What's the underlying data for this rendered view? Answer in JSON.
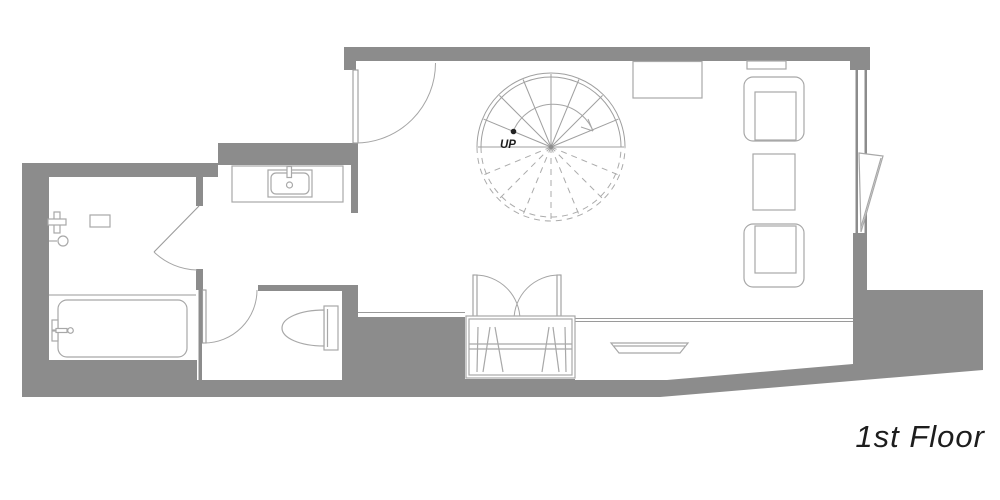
{
  "plan": {
    "floor_label": "1st Floor",
    "stair_direction_label": "UP"
  },
  "colors": {
    "wall_fill": "#8c8c8c",
    "background": "#ffffff",
    "label_text": "#1d1d1d"
  }
}
